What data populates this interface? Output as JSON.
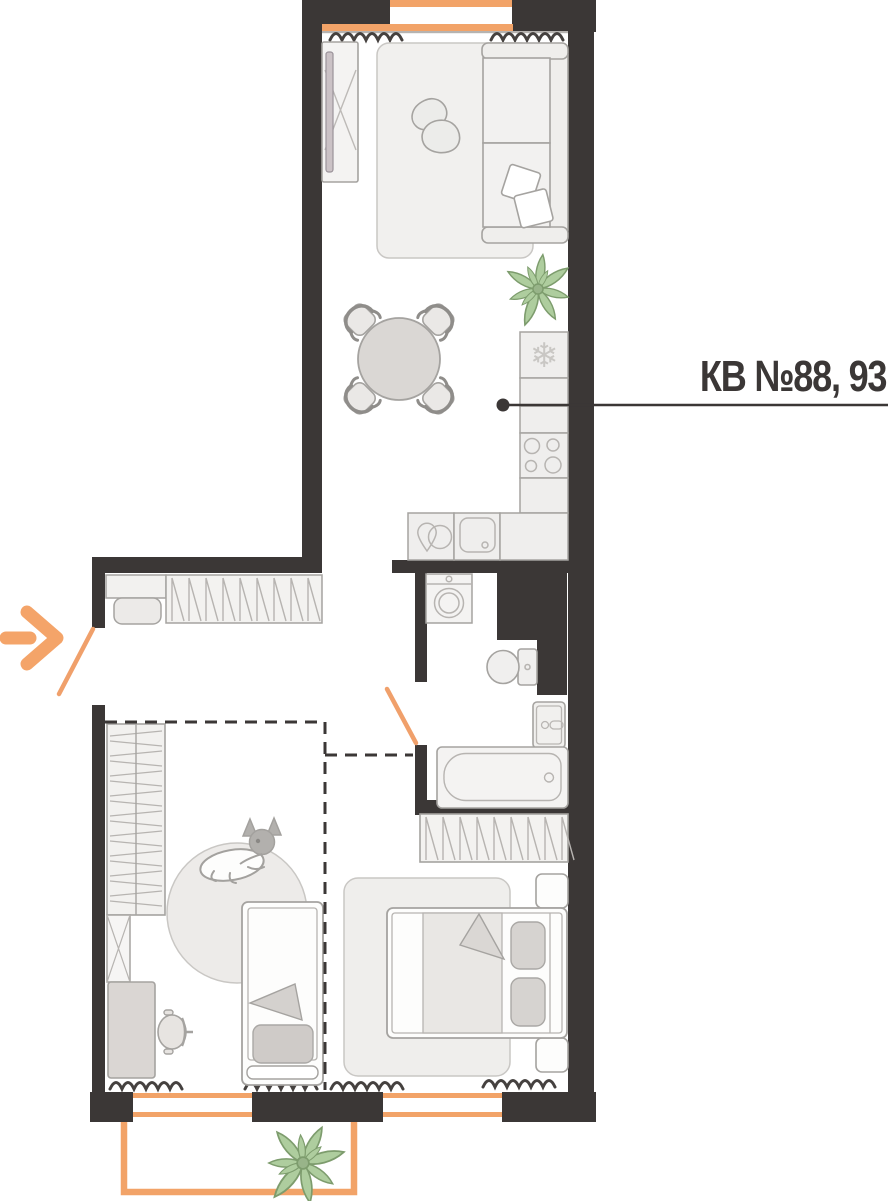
{
  "plan": {
    "apartment_label": "КВ №88, 93",
    "kind": "apartment floor plan"
  },
  "colors": {
    "wall": "#3B3736",
    "accent_orange": "#F2A368",
    "plant_green": "#AECD9E",
    "outline_gray": "#A5A3A0",
    "fill_light": "#F2F1EF"
  },
  "icons": [
    "entry-arrow-icon",
    "door-swing-icon",
    "snowflake-icon",
    "dishwasher-icon",
    "stove-burners-icon",
    "washing-machine-icon",
    "toilet-icon",
    "bathtub-icon",
    "sink-icon",
    "plant-icon",
    "dog-icon",
    "curtain-squiggle-icon"
  ],
  "furniture": [
    "tv-stand",
    "living-rug",
    "bean-bags",
    "corner-sofa",
    "pillows",
    "dining-table",
    "dining-chairs",
    "fridge",
    "kitchen-counter",
    "stove",
    "kitchen-sink",
    "dishwasher",
    "entry-console",
    "entry-pouf",
    "hall-wardrobe",
    "washing-machine",
    "toilet",
    "bath-sink",
    "bathtub",
    "shelf-wardrobe",
    "x-cabinet",
    "desk",
    "desk-chair",
    "round-rug",
    "dog",
    "child-bed",
    "bedroom-wardrobe",
    "nightstand",
    "bedroom-rug",
    "double-bed",
    "balcony",
    "balcony-plant"
  ]
}
